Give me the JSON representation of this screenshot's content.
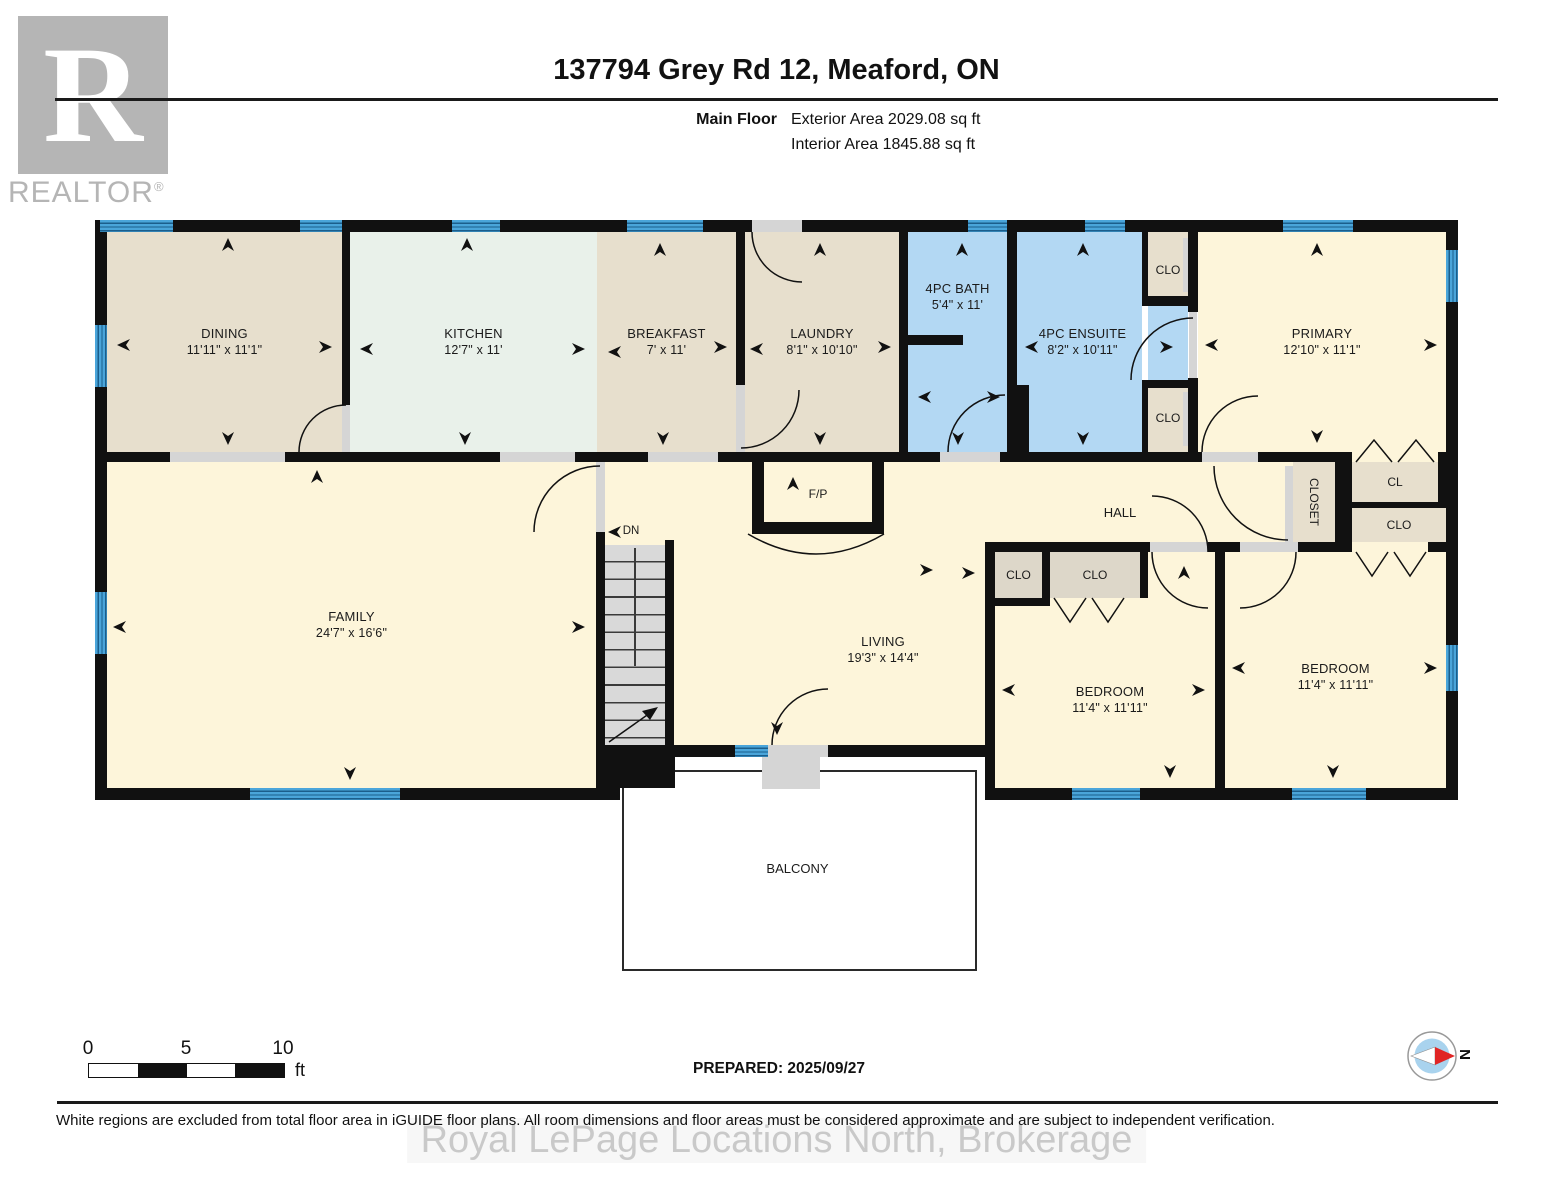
{
  "header": {
    "logo_letter": "R",
    "logo": "REALTOR",
    "logo_reg": "®",
    "title": "137794 Grey Rd 12, Meaford, ON",
    "floor_label": "Main Floor",
    "exterior_area": "Exterior Area 2029.08 sq ft",
    "interior_area": "Interior Area 1845.88 sq ft"
  },
  "rooms": {
    "dining": {
      "name": "DINING",
      "dims": "11'11\" x 11'1\""
    },
    "kitchen": {
      "name": "KITCHEN",
      "dims": "12'7\" x 11'"
    },
    "breakfast": {
      "name": "BREAKFAST",
      "dims": "7' x 11'"
    },
    "laundry": {
      "name": "LAUNDRY",
      "dims": "8'1\" x 10'10\""
    },
    "bath": {
      "name": "4PC BATH",
      "dims": "5'4\" x 11'"
    },
    "ensuite": {
      "name": "4PC ENSUITE",
      "dims": "8'2\" x 10'11\""
    },
    "primary": {
      "name": "PRIMARY",
      "dims": "12'10\" x 11'1\""
    },
    "family": {
      "name": "FAMILY",
      "dims": "24'7\" x 16'6\""
    },
    "living": {
      "name": "LIVING",
      "dims": "19'3\" x 14'4\""
    },
    "bedroom1": {
      "name": "BEDROOM",
      "dims": "11'4\" x 11'11\""
    },
    "bedroom2": {
      "name": "BEDROOM",
      "dims": "11'4\" x 11'11\""
    },
    "hall": {
      "name": "HALL"
    },
    "balcony": {
      "name": "BALCONY"
    },
    "fireplace": {
      "name": "F/P"
    },
    "stairs": {
      "name": "DN"
    }
  },
  "closets": {
    "clo": "CLO",
    "cl": "CL",
    "closet": "CLOSET"
  },
  "footer": {
    "scale_ticks": [
      "0",
      "5",
      "10"
    ],
    "scale_unit": "ft",
    "prepared": "PREPARED: 2025/09/27",
    "compass_n": "N",
    "disclaimer": "White regions are excluded from total floor area in iGUIDE floor plans. All room dimensions and floor areas must be considered approximate and are subject to independent verification.",
    "watermark": "Royal LePage Locations North, Brokerage"
  },
  "colors": {
    "wall": "#111111",
    "window_blue": "#4aa5da",
    "room_tan": "#e7dfcd",
    "room_mint": "#e9f1ea",
    "room_blue": "#b3d8f3",
    "room_cream": "#fdf5da",
    "closet_grey": "#ddd7c9",
    "stair_grey": "#d9d9d9",
    "compass_red": "#e02525"
  }
}
